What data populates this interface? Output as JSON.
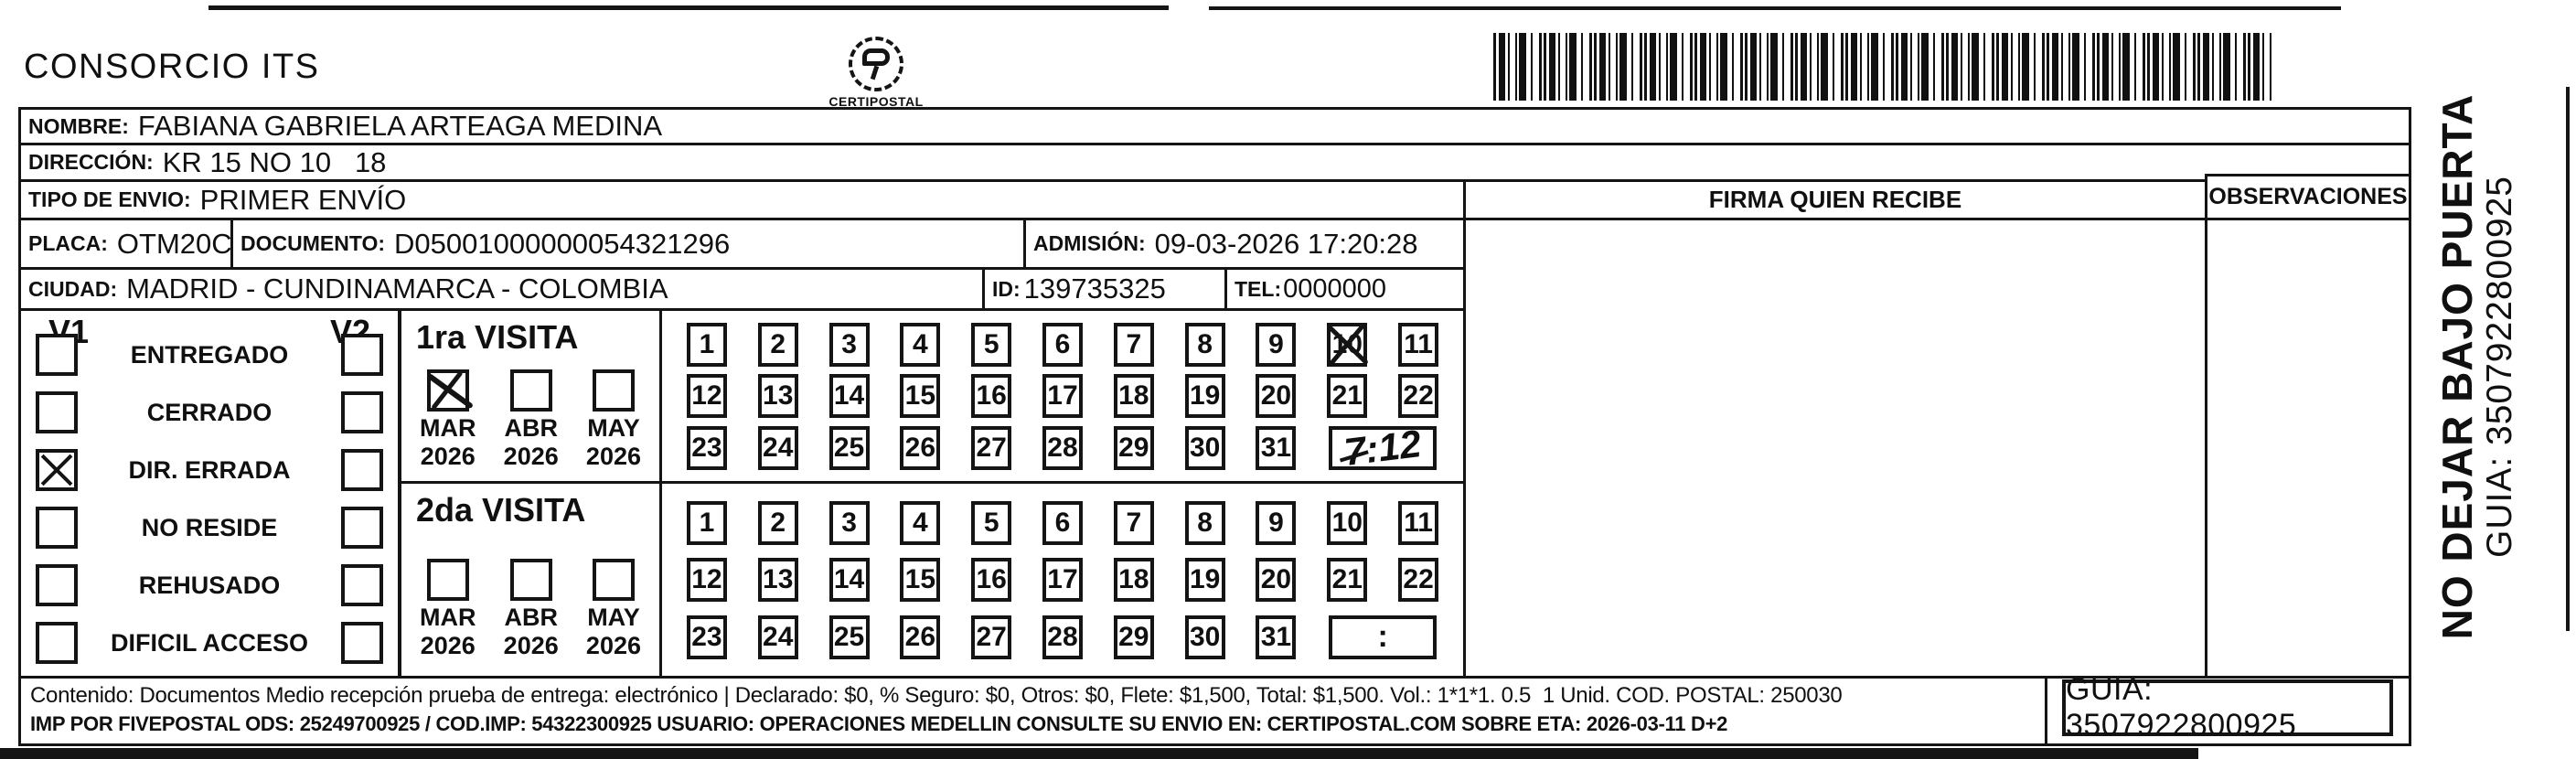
{
  "header": {
    "company": "CONSORCIO ITS",
    "nit_line1": "NIT 900 413 115 - TEL 604 3201000",
    "nit_line2": "Carrera 64C N 72 - 58 MEDELLIN ANTIOQUIA",
    "logo_text": "CERTIPOSTAL",
    "certipostal_line1": "CERTIPOSTAL SAS | 900 151 122 - 2",
    "certipostal_line2": "Carrera 80d N 18 16  Lic. 2519 De Octubre 23 De 2015"
  },
  "recipient": {
    "nombre_label": "NOMBRE:",
    "nombre": "FABIANA GABRIELA ARTEAGA MEDINA",
    "direccion_label": "DIRECCIÓN:",
    "direccion": "KR 15 NO 10   18",
    "tipo_envio_label": "TIPO DE ENVIO:",
    "tipo_envio": "PRIMER ENVÍO",
    "placa_label": "PLACA:",
    "placa": "OTM20C",
    "documento_label": "DOCUMENTO:",
    "documento": "D05001000000054321296",
    "admision_label": "ADMISIÓN:",
    "admision": "09-03-2026 17:20:28",
    "ciudad_label": "CIUDAD:",
    "ciudad": "MADRID - CUNDINAMARCA - COLOMBIA",
    "id_label": "ID:",
    "id": "139735325",
    "tel_label": "TEL:",
    "tel": "0000000"
  },
  "signature": {
    "firma_header": "FIRMA QUIEN RECIBE",
    "observaciones_header": "OBSERVACIONES"
  },
  "delivery_status": {
    "v1_label": "V1",
    "v2_label": "V2",
    "options": [
      {
        "label": "ENTREGADO",
        "v1": false,
        "v2": false
      },
      {
        "label": "CERRADO",
        "v1": false,
        "v2": false
      },
      {
        "label": "DIR. ERRADA",
        "v1": true,
        "v2": false
      },
      {
        "label": "NO RESIDE",
        "v1": false,
        "v2": false
      },
      {
        "label": "REHUSADO",
        "v1": false,
        "v2": false
      },
      {
        "label": "DIFICIL ACCESO",
        "v1": false,
        "v2": false
      }
    ]
  },
  "visits": {
    "first": {
      "title": "1ra VISITA",
      "months": [
        {
          "label": "MAR",
          "year": "2026",
          "checked": true
        },
        {
          "label": "ABR",
          "year": "2026",
          "checked": false
        },
        {
          "label": "MAY",
          "year": "2026",
          "checked": false
        }
      ],
      "days": 31,
      "crossed_day": 10,
      "time": "7:12",
      "time_style": "handwritten"
    },
    "second": {
      "title": "2da VISITA",
      "months": [
        {
          "label": "MAR",
          "year": "2026",
          "checked": false
        },
        {
          "label": "ABR",
          "year": "2026",
          "checked": false
        },
        {
          "label": "MAY",
          "year": "2026",
          "checked": false
        }
      ],
      "days": 31,
      "crossed_day": null,
      "time": ":",
      "time_style": "printed"
    }
  },
  "side_note": {
    "line1": "NO DEJAR BAJO PUERTA",
    "line2": "GUIA: 3507922800925"
  },
  "footer": {
    "line1": "Contenido: Documentos Medio recepción prueba de entrega: electrónico | Declarado: $0, % Seguro: $0, Otros: $0, Flete: $1,500, Total: $1,500. Vol.: 1*1*1. 0.5  1 Unid. COD. POSTAL: 250030",
    "line2": "IMP POR FIVEPOSTAL ODS: 25249700925 / COD.IMP: 54322300925 USUARIO: OPERACIONES MEDELLIN CONSULTE SU ENVIO EN: CERTIPOSTAL.COM SOBRE ETA: 2026-03-11 D+2",
    "guia": "GUIA: 3507922800925"
  }
}
